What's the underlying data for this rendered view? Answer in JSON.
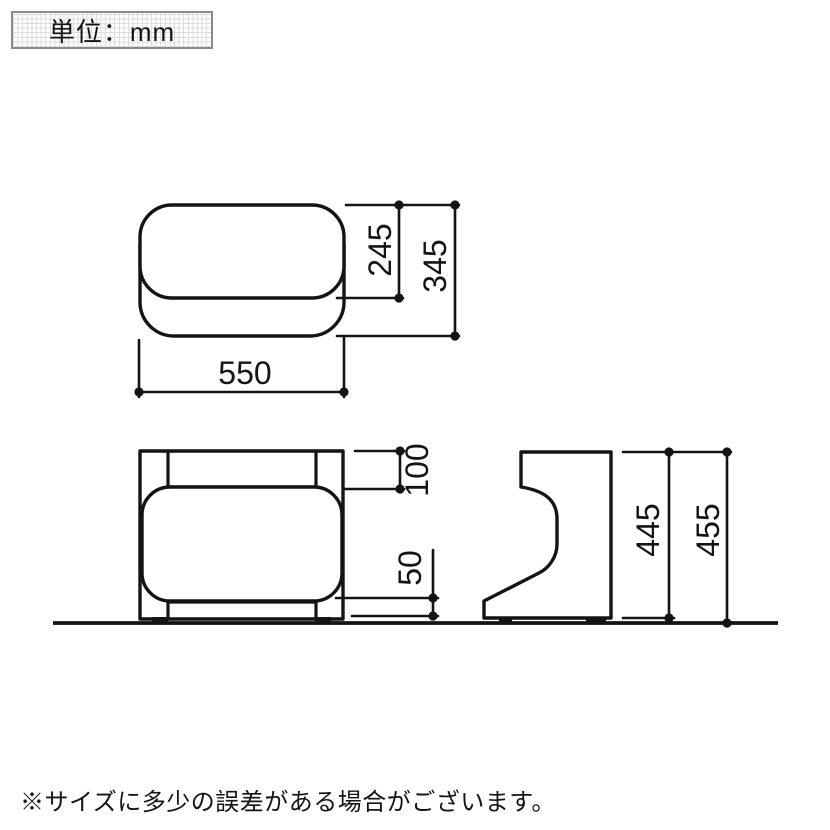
{
  "unit_box": {
    "text": "単位：mm"
  },
  "note": {
    "text": "※サイズに多少の誤差がある場合がございます。"
  },
  "dimensions": {
    "top_view": {
      "width_mm": "550",
      "cushion_depth_mm": "245",
      "total_depth_mm": "345"
    },
    "front_view": {
      "top_gap_mm": "100",
      "base_height_mm": "50"
    },
    "side_view": {
      "frame_height_mm": "445",
      "total_height_mm": "455"
    }
  },
  "colors": {
    "line": "#141414",
    "text": "#141414",
    "unit_box_border": "#8a8a8a",
    "unit_box_grid": "#dcdcdc",
    "background": "#ffffff"
  }
}
